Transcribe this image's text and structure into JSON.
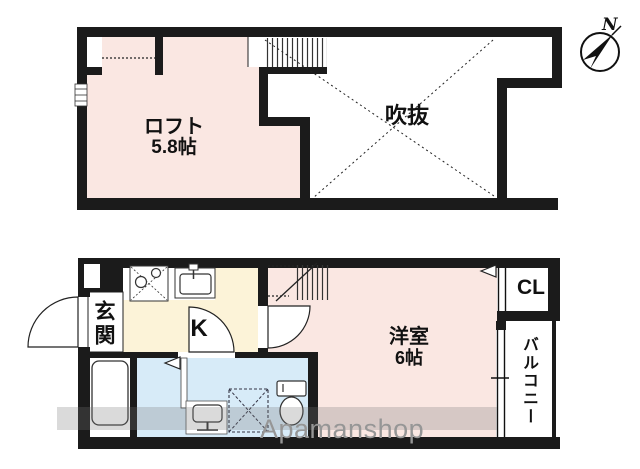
{
  "upper_floor": {
    "loft_label": "ロフト",
    "loft_size": "5.8帖",
    "void_label": "吹抜"
  },
  "lower_floor": {
    "entrance_label": "玄関",
    "kitchen_label": "K",
    "room_label": "洋室",
    "room_size": "6帖",
    "closet_label": "CL",
    "balcony_label": "バルコニー"
  },
  "compass": {
    "north_label": "N"
  },
  "watermark_text": "Apamanshop",
  "colors": {
    "room_pink": "#fae7e2",
    "kitchen_cream": "#fcf3d8",
    "wet_area_blue": "#d7ebf8",
    "wall_black": "#1b1b1b",
    "watermark_gray": "#969696"
  },
  "icons": {
    "compass": "north-arrow",
    "stove": "two-burner-stove",
    "sink": "kitchen-sink",
    "bathtub": "bathtub",
    "toilet": "toilet",
    "washbasin": "washbasin",
    "stairs": "hatched-staircase",
    "door": "quarter-circle-swing"
  }
}
